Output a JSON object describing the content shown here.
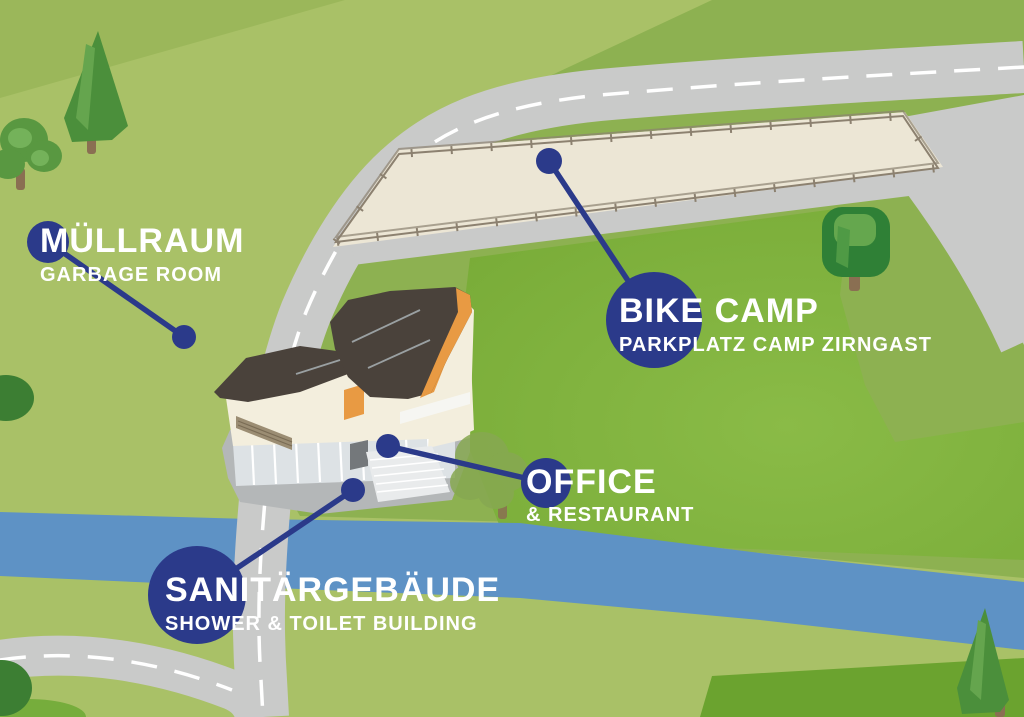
{
  "map": {
    "name": "Camp Zirngast site map",
    "locations": [
      {
        "id": "muellraum",
        "title": "MÜLLRAUM",
        "subtitle": "GARBAGE ROOM"
      },
      {
        "id": "bike-camp",
        "title": "BIKE CAMP",
        "subtitle": "PARKPLATZ CAMP ZIRNGAST"
      },
      {
        "id": "office",
        "title": "OFFICE",
        "subtitle": "& RESTAURANT"
      },
      {
        "id": "sanitaergebaeude",
        "title": "SANITÄRGEBÄUDE",
        "subtitle": "SHOWER & TOILET BUILDING"
      }
    ],
    "features": [
      "parking-area",
      "main-road",
      "parking-access-road",
      "branch-road",
      "bottom-road",
      "river",
      "camp-field",
      "main-building",
      "trees"
    ]
  },
  "colors": {
    "navy": "#2b3a8a",
    "olive_base": "#a9c167",
    "olive_corner": "#9bb75a",
    "green_dark_zone": "#8db151",
    "field_green": "#79ac38",
    "field_green_light": "#8abb47",
    "green_patch_dark": "#6ba32f",
    "river_blue": "#5e92c5",
    "road_gray": "#c9cac9",
    "parking_beige": "#ece6d5",
    "fence_brown": "#8c8170",
    "roof_dark": "#4a423b",
    "wall_cream": "#f3eedd",
    "accent_orange": "#e89a43",
    "label_text": "#ffffff"
  }
}
